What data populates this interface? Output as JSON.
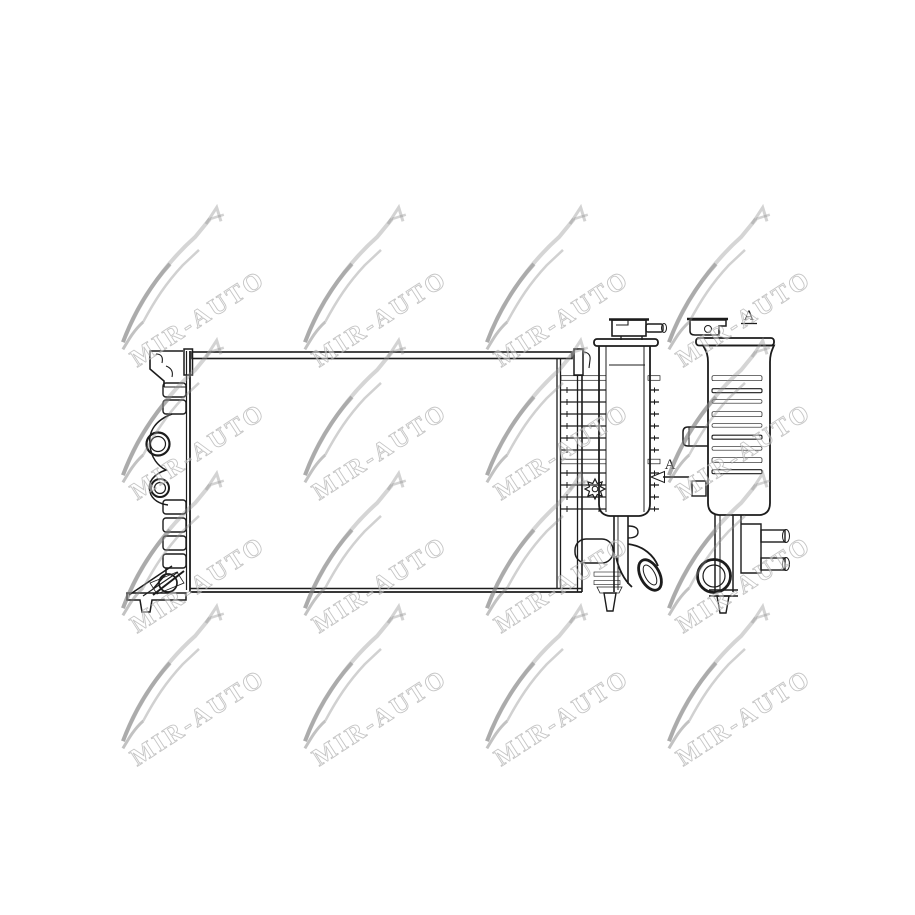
{
  "watermark": {
    "text": "MIR-AUTO"
  },
  "annotations": {
    "view_label": "A",
    "arrow_label": "A"
  },
  "colors": {
    "line": "#1c1c1c",
    "shade_gray": "#8f8f8f",
    "watermark_gray": "#969696",
    "background": "#ffffff"
  }
}
